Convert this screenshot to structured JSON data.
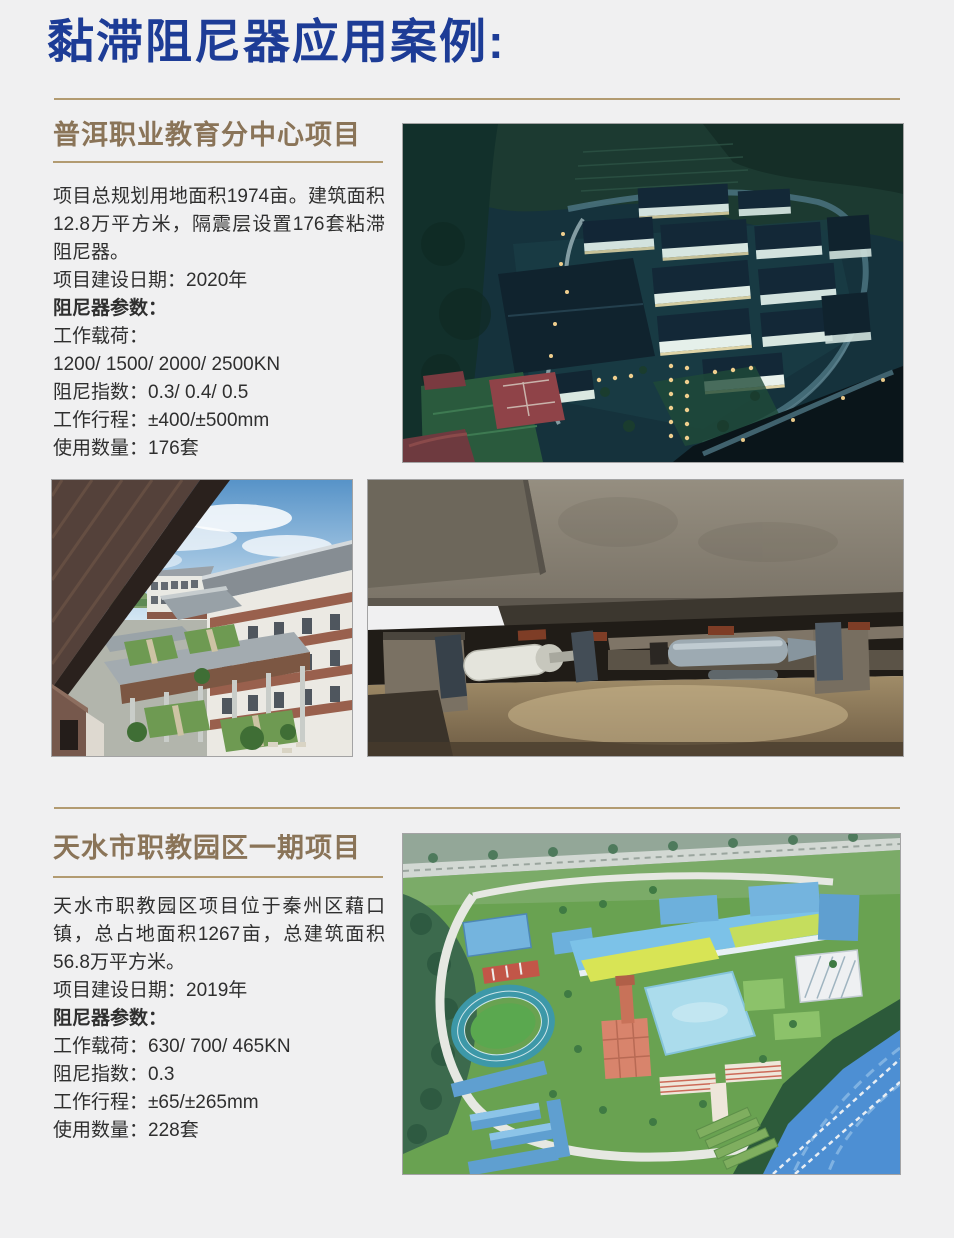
{
  "page": {
    "title": "黏滞阻尼器应用案例:",
    "colors": {
      "background": "#f0f0f1",
      "title_blue": "#1d3c96",
      "heading_brown": "#8a7458",
      "rule_gold": "#b29b71",
      "body_text": "#2f2f2f"
    }
  },
  "sections": [
    {
      "heading": "普洱职业教育分中心项目",
      "paragraph_lines": [
        "项目总规划用地面积1974亩。建筑面积",
        "12.8万平方米，隔震层设置176套粘滞",
        "阻尼器。"
      ],
      "build_date": "项目建设日期：2020年",
      "params_title": "阻尼器参数：",
      "param_lines": [
        "工作载荷：",
        "1200/ 1500/ 2000/ 2500KN",
        "阻尼指数：0.3/ 0.4/ 0.5",
        "工作行程：±400/±500mm",
        "使用数量：176套"
      ],
      "photos": [
        {
          "label": "项目校园夜景航拍照片"
        },
        {
          "label": "教学楼庭院实景照片"
        },
        {
          "label": "隔震层粘滞阻尼器安装照片"
        }
      ]
    },
    {
      "heading": "天水市职教园区一期项目",
      "paragraph_lines": [
        "天水市职教园区项目位于秦州区藉口",
        "镇，总占地面积1267亩，总建筑面积",
        "56.8万平方米。"
      ],
      "build_date": "项目建设日期：2019年",
      "params_title": "阻尼器参数：",
      "param_lines": [
        "工作载荷：630/ 700/ 465KN",
        "阻尼指数：0.3",
        "工作行程：±65/±265mm",
        "使用数量：228套"
      ],
      "photos": [
        {
          "label": "园区整体规划鸟瞰效果图"
        }
      ]
    }
  ]
}
